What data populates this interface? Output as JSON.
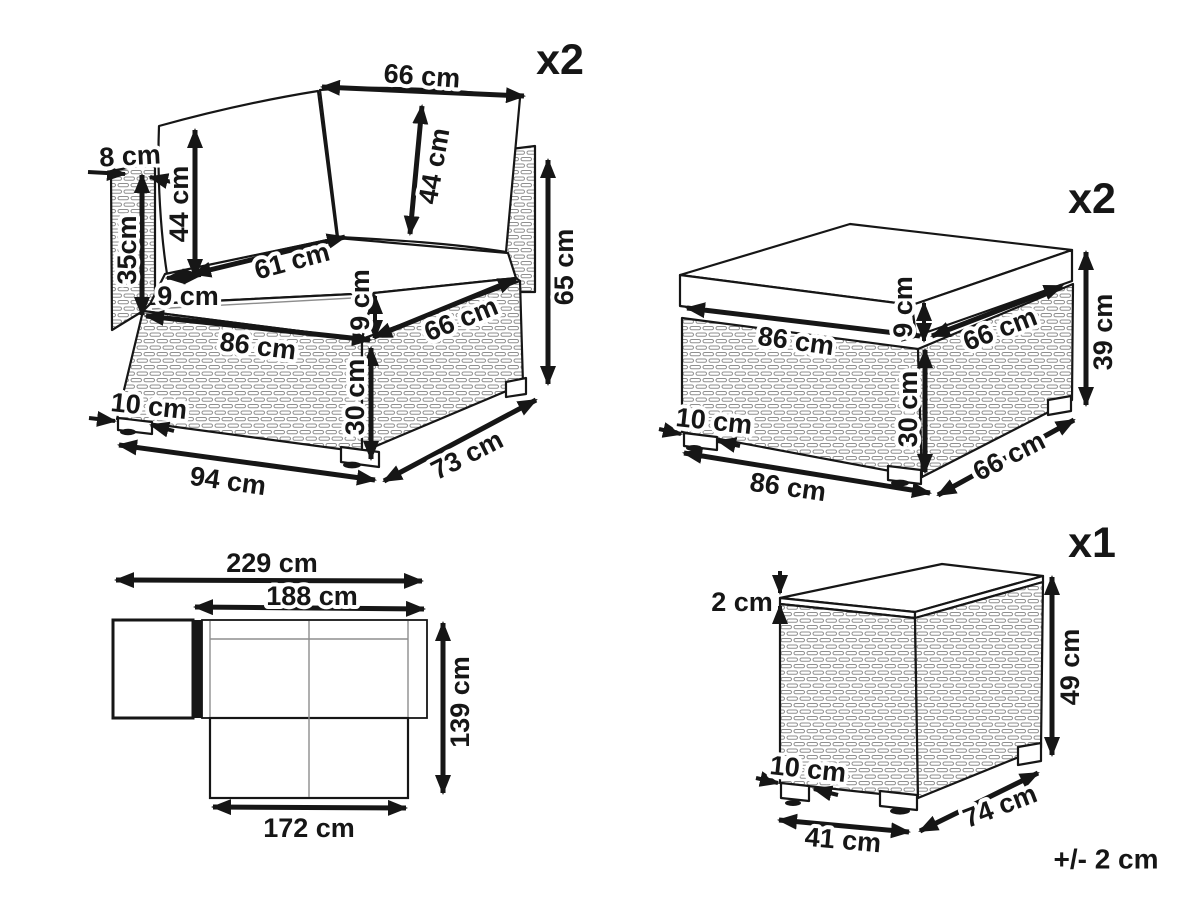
{
  "tolerance_note": "+/- 2 cm",
  "diagrams": {
    "corner_sofa": {
      "quantity": "x2",
      "labels": {
        "back_width": "66 cm",
        "side_panel_thickness": "8 cm",
        "left_cushion_height": "44 cm",
        "right_cushion_height": "44 cm",
        "side_panel_above_seat": "35cm",
        "seat_depth": "61 cm",
        "side_clearance": "9 cm",
        "seat_cushion_thickness": "9 cm",
        "front_width": "86 cm",
        "seat_side_width": "66 cm",
        "total_height": "65 cm",
        "base_height": "30 cm",
        "leg_width": "10 cm",
        "overall_width": "94 cm",
        "overall_depth": "73 cm"
      }
    },
    "ottoman": {
      "quantity": "x2",
      "labels": {
        "cushion_front_width": "86 cm",
        "cushion_thickness": "9 cm",
        "cushion_side_depth": "66 cm",
        "total_height": "39 cm",
        "base_height": "30 cm",
        "leg_width": "10 cm",
        "base_front_width": "86 cm",
        "base_side_depth": "66 cm"
      }
    },
    "floor_plan": {
      "labels": {
        "overall_width": "229 cm",
        "sofa_width": "188 cm",
        "overall_depth": "139 cm",
        "front_row_width": "172 cm"
      }
    },
    "side_table": {
      "quantity": "x1",
      "labels": {
        "top_thickness": "2 cm",
        "height": "49 cm",
        "leg_width": "10 cm",
        "front_width": "41 cm",
        "side_depth": "74 cm"
      }
    }
  }
}
